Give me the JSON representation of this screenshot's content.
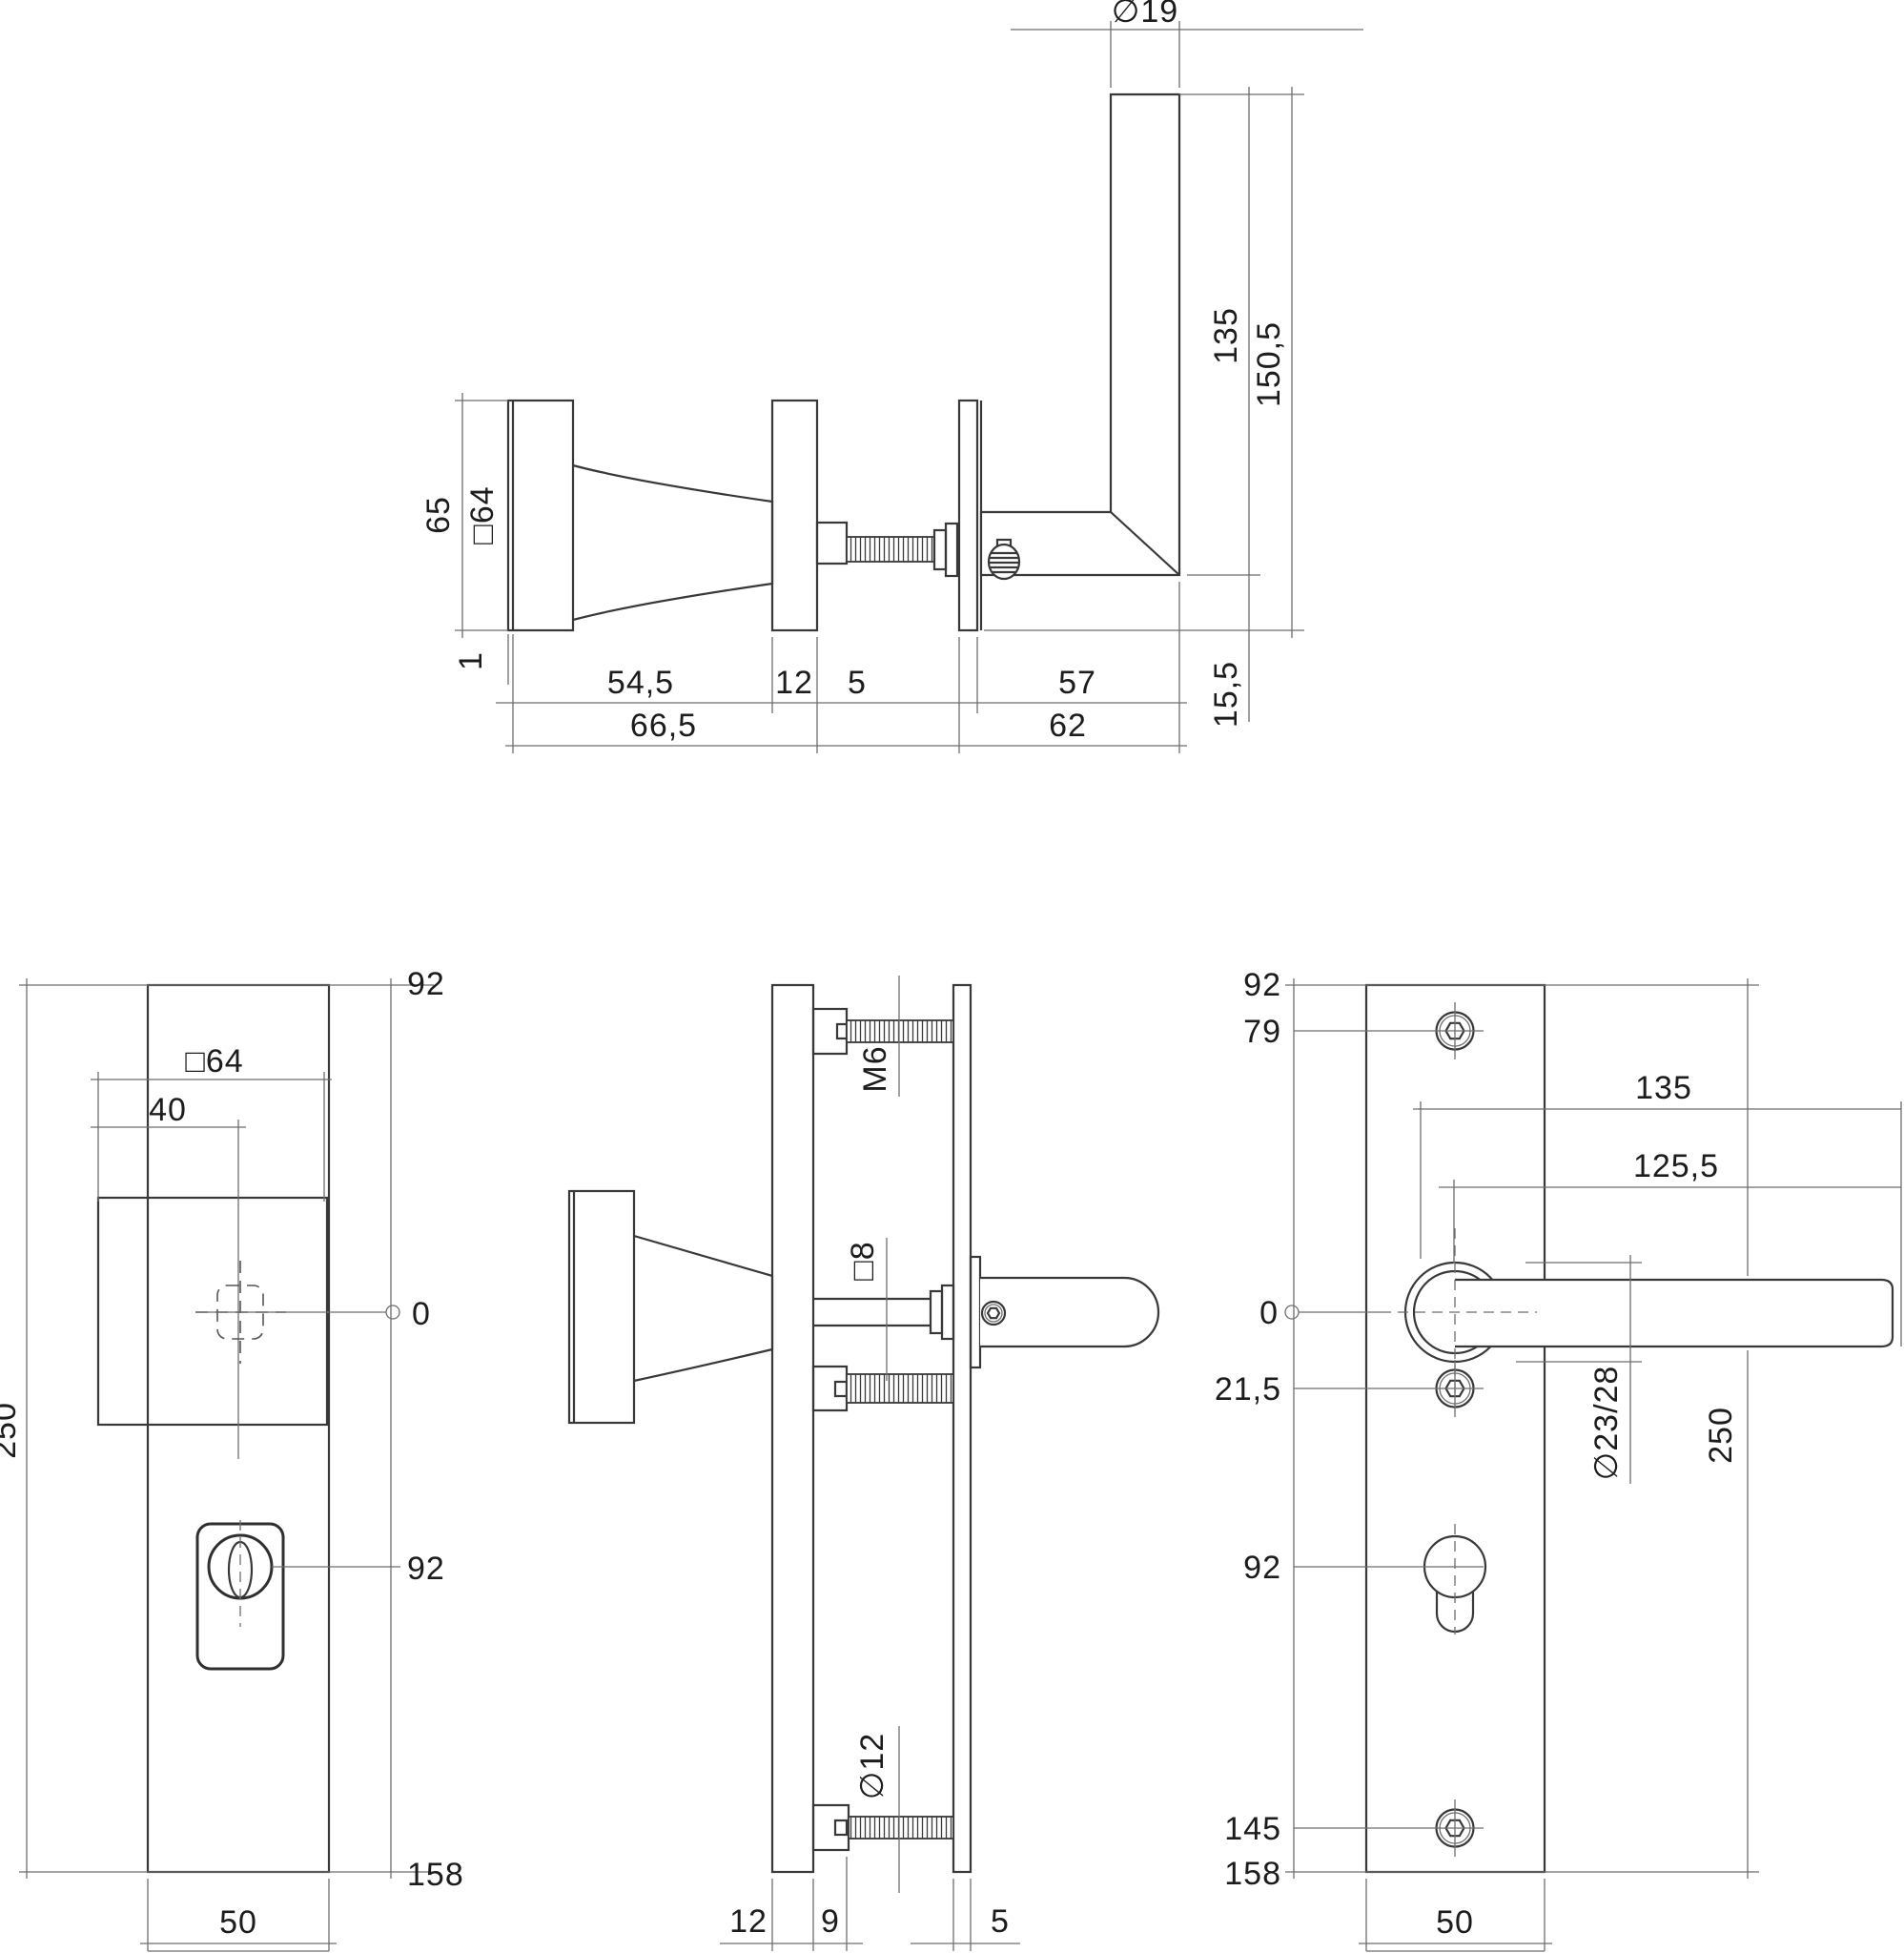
{
  "drawing": {
    "kind": "technical-dimension-drawing",
    "background": "#ffffff",
    "line_color": "#383838",
    "dim_color": "#6e6e6e"
  },
  "views": {
    "top_view": {
      "diameter_19": "∅19",
      "height_135": "135",
      "height_150_5": "150,5",
      "height_65": "65",
      "square_64": "□64",
      "step_1": "1",
      "depth_54_5": "54,5",
      "plate_12": "12",
      "total_66_5": "66,5",
      "gap_5": "5",
      "length_57": "57",
      "total_62": "62",
      "height_15_5": "15,5"
    },
    "left_view": {
      "top_92": "92",
      "square_64": "□64",
      "offset_40": "40",
      "zero": "0",
      "height_250": "250",
      "cylinder_92": "92",
      "bottom_158": "158",
      "width_50": "50"
    },
    "middle_view": {
      "thread_m6": "M6",
      "square_8": "□8",
      "diameter_12": "∅12",
      "plate_12": "12",
      "boss_9": "9",
      "plate_5": "5"
    },
    "right_view": {
      "top_92": "92",
      "hole_79": "79",
      "lever_135": "135",
      "lever_125_5": "125,5",
      "zero": "0",
      "hole_21_5": "21,5",
      "rose_diameter": "∅23/28",
      "height_250": "250",
      "cylinder_92": "92",
      "hole_145": "145",
      "bottom_158": "158",
      "width_50": "50"
    }
  }
}
